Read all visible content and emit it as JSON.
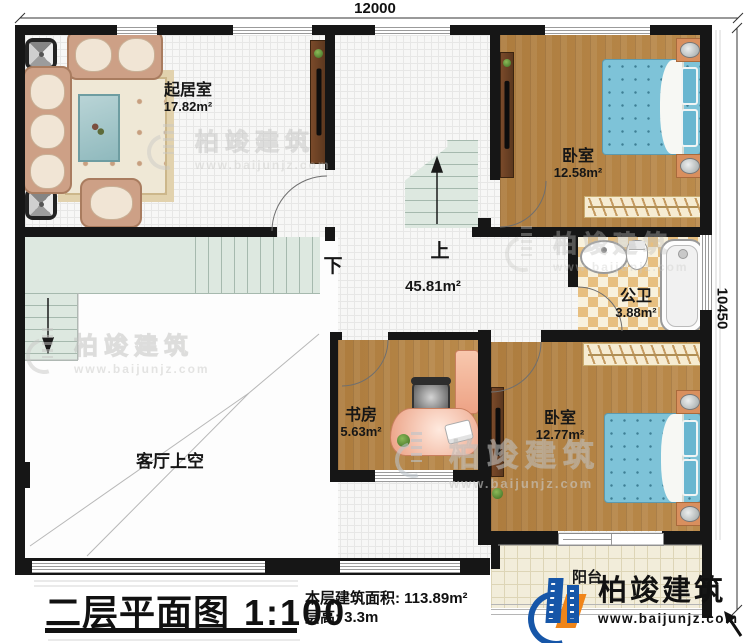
{
  "dimensions": {
    "width_mm": "12000",
    "height_mm": "10450"
  },
  "rooms": {
    "living": {
      "name": "起居室",
      "area": "17.82m²"
    },
    "bedroom1": {
      "name": "卧室",
      "area": "12.58m²"
    },
    "bathroom": {
      "name": "公卫",
      "area": "3.88m²"
    },
    "hall": {
      "area": "45.81m²",
      "up": "上",
      "down": "下"
    },
    "study": {
      "name": "书房",
      "area": "5.63m²"
    },
    "bedroom2": {
      "name": "卧室",
      "area": "12.77m²"
    },
    "void": {
      "name": "客厅上空"
    },
    "balcony": {
      "name": "阳台"
    }
  },
  "titleblock": {
    "title": "二层平面图",
    "scale": "1:100",
    "area_label": "本层建筑面积:",
    "area_value": "113.89m²",
    "floor_height_label": "层高:",
    "floor_height_value": "3.3m"
  },
  "brand": {
    "name": "柏竣建筑",
    "website": "www.baijunjz.com"
  },
  "watermark": {
    "name": "柏竣建筑",
    "website": "www.baijunjz.com"
  },
  "colors": {
    "wall": "#161616",
    "wood_floor": "#b08143",
    "mattress_blue": "#7ec3d8",
    "bath_tile": "#e7bf80",
    "stair_green": "#dde8e0",
    "logo_blue": "#1656a8",
    "logo_orange": "#f08519"
  }
}
